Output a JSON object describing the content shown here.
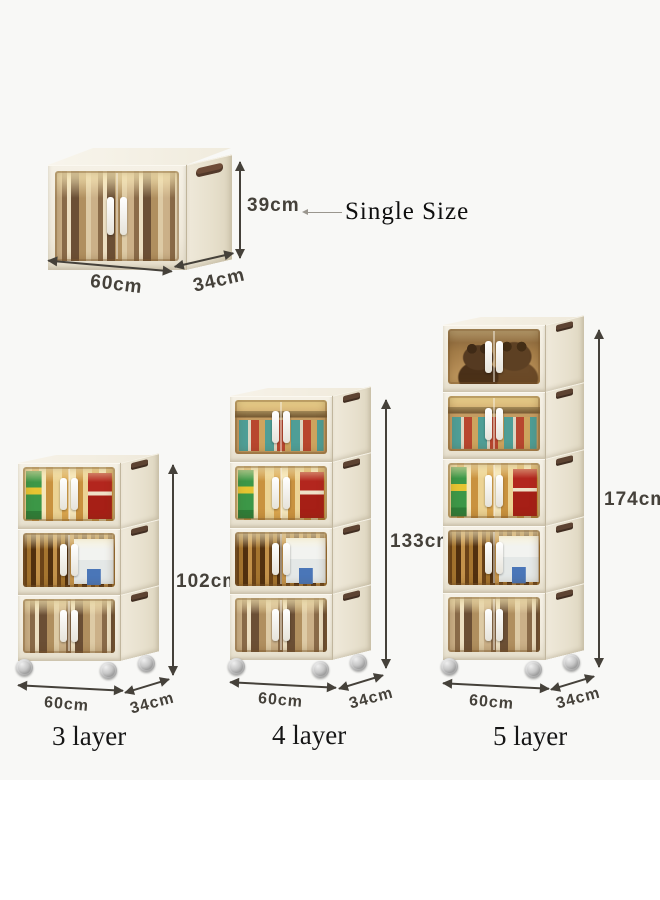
{
  "single_size": {
    "label": "Single Size",
    "height": "39cm",
    "width": "60cm",
    "depth": "34cm",
    "contents": [
      "books"
    ]
  },
  "cabinets": [
    {
      "label": "3 layer",
      "height": "102cm",
      "width": "60cm",
      "depth": "34cm",
      "layers": [
        "snacks",
        "bottles",
        "books"
      ]
    },
    {
      "label": "4 layer",
      "height": "133cm",
      "width": "60cm",
      "depth": "34cm",
      "layers": [
        "jars",
        "snacks",
        "bottles",
        "books"
      ]
    },
    {
      "label": "5 layer",
      "height": "174cm",
      "width": "60cm",
      "depth": "34cm",
      "layers": [
        "plush-toys",
        "jars",
        "snacks",
        "bottles",
        "books"
      ]
    }
  ],
  "colors": {
    "canvas": "#f8f8f6",
    "body_cream": "#efe9da",
    "door_amber": "#c49c62",
    "clip_brown": "#5d4332",
    "dimension_ink": "#45413a"
  }
}
